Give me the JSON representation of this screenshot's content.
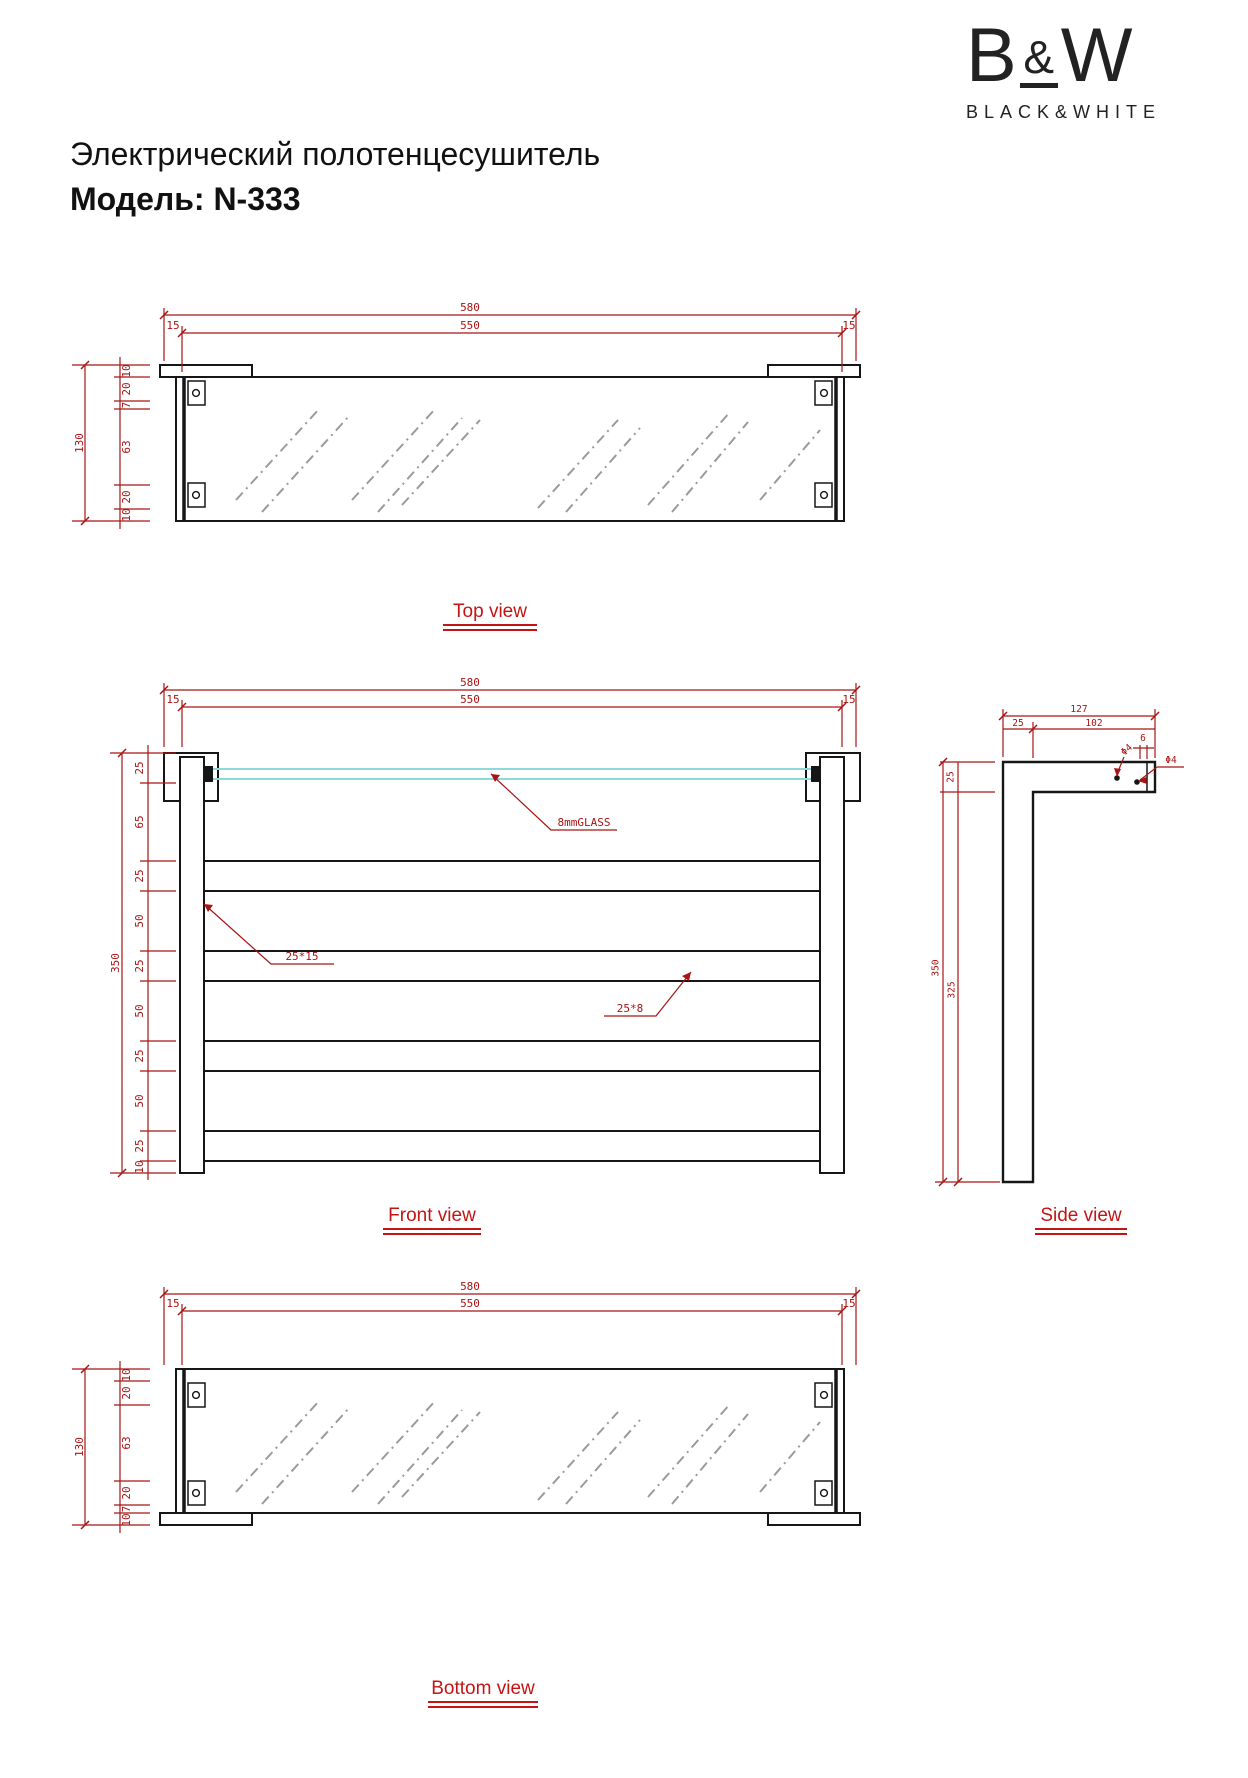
{
  "logo": {
    "b": "B",
    "amp": "&",
    "w": "W",
    "subtitle": "BLACK&WHITE"
  },
  "title": {
    "product": "Электрический полотенцесушитель",
    "model": "Модель: N-333"
  },
  "colors": {
    "dim_red": "#a81414",
    "label_red": "#c41414",
    "line_black": "#161616",
    "glass_cyan": "#8fd8d8",
    "hatch_gray": "#9a9a9a"
  },
  "views": {
    "top": {
      "label": "Top view",
      "width_overall": "580",
      "width_inner": "550",
      "margin_left": "15",
      "margin_right": "15",
      "depth_overall": "130",
      "chain": [
        "10",
        "20",
        "7",
        "63",
        "20",
        "10"
      ]
    },
    "front": {
      "label": "Front view",
      "width_overall": "580",
      "width_inner": "550",
      "margin_left": "15",
      "margin_right": "15",
      "height_overall": "350",
      "chain": [
        "25",
        "65",
        "25",
        "50",
        "25",
        "50",
        "25",
        "50",
        "25",
        "10"
      ],
      "glass_note": "8mmGLASS",
      "post_profile": "25*15",
      "rail_profile": "25*8"
    },
    "side": {
      "label": "Side view",
      "depth_overall": "127",
      "depth_post": "25",
      "depth_arm": "102",
      "lip": "6",
      "hole_top": "Φ4",
      "hole_front": "Φ4",
      "arm_height": "25",
      "height_overall": "350",
      "height_post": "325"
    },
    "bottom": {
      "label": "Bottom view",
      "width_overall": "580",
      "width_inner": "550",
      "margin_left": "15",
      "margin_right": "15",
      "depth_overall": "130",
      "chain": [
        "10",
        "20",
        "63",
        "20",
        "7",
        "10"
      ]
    }
  }
}
